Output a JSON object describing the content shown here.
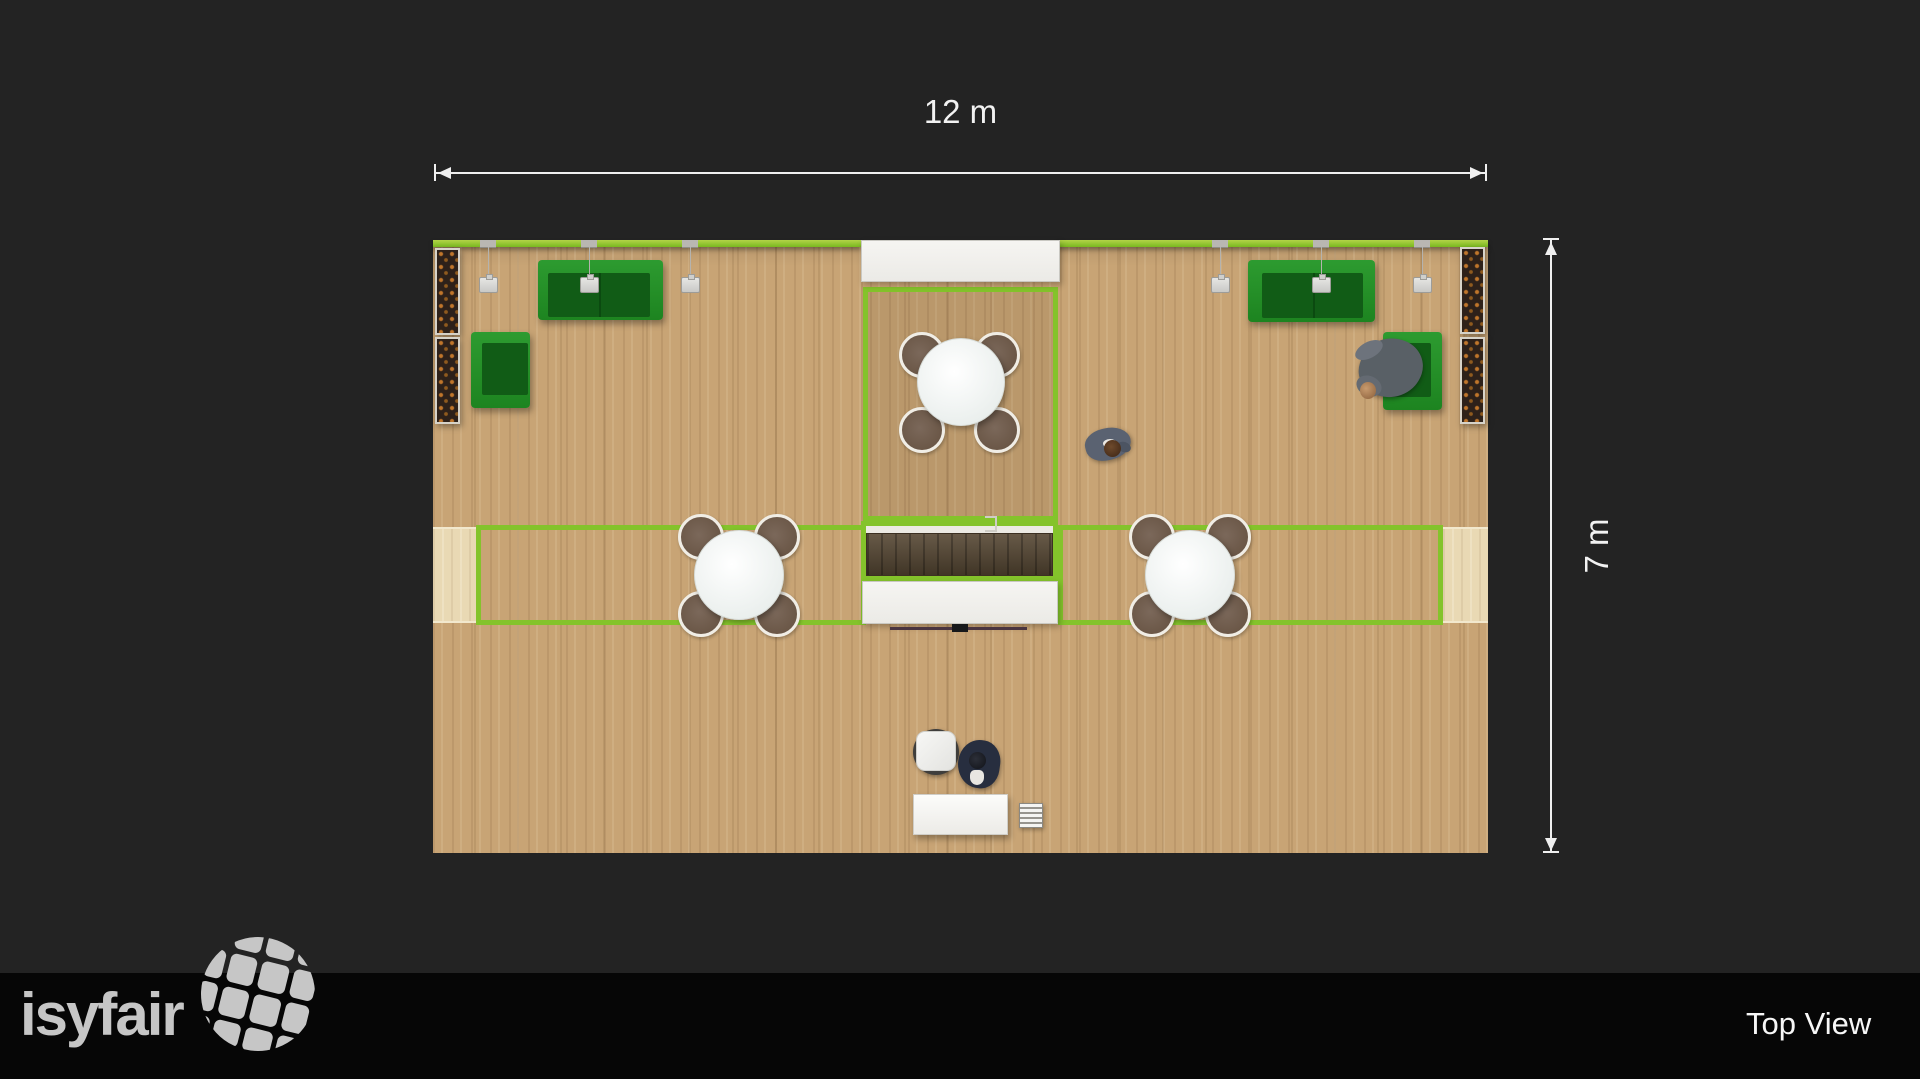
{
  "app": {
    "brand": "isyfair",
    "view_label": "Top View"
  },
  "dimensions": {
    "width_label": "12 m",
    "height_label": "7 m",
    "booth_width_m": 12,
    "booth_depth_m": 7
  },
  "colors": {
    "background": "#232323",
    "footer_bar": "#060606",
    "accent_lime_wall": "#84c32b",
    "furniture_green": "#1d8420",
    "floor_wood": "#c8a475",
    "walkway_wood": "#e9d9b4",
    "counter_brown": "#564733",
    "dimension_lines": "#efefef",
    "logo_gray": "#c6c6c6"
  },
  "scene": {
    "objects": [
      "green-wall-with-spotlights",
      "pendant-lamp",
      "pendant-lamp",
      "pendant-lamp",
      "pendant-lamp",
      "pendant-lamp",
      "pendant-lamp",
      "planter-box",
      "planter-box",
      "planter-box",
      "planter-box",
      "green-sofa",
      "green-sofa",
      "green-armchair",
      "green-armchair",
      "round-table-with-4-chairs",
      "round-table-with-4-chairs",
      "round-table-with-4-chairs",
      "meeting-room",
      "counter-desk",
      "storage-room",
      "storage-room",
      "reception-desk",
      "stool",
      "drawer-unit",
      "person-sitting",
      "person-walking",
      "person-at-desk"
    ]
  }
}
